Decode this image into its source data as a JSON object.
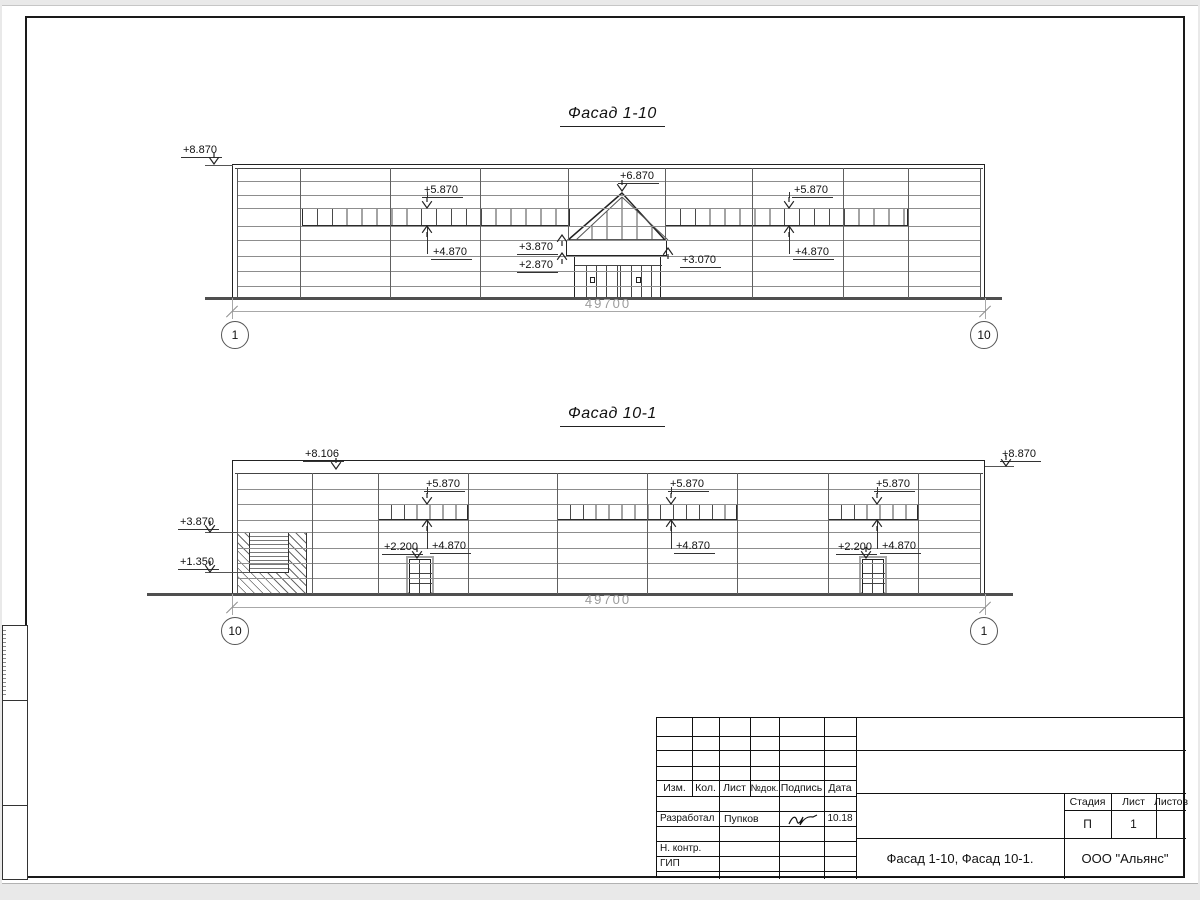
{
  "sheet": {
    "facade1": {
      "title": "Фасад 1-10",
      "dimension": "49700",
      "axis_left": "1",
      "axis_right": "10",
      "marks": {
        "top_left": "+8.870",
        "band_left_top": "+5.870",
        "band_left_bottom": "+4.870",
        "apex": "+6.870",
        "canopy_left_upper": "+3.870",
        "canopy_left_lower": "+2.870",
        "canopy_right": "+3.070",
        "band_right_top": "+5.870",
        "band_right_bottom": "+4.870"
      }
    },
    "facade2": {
      "title": "Фасад 10-1",
      "dimension": "49700",
      "axis_left": "10",
      "axis_right": "1",
      "marks": {
        "parapet": "+8.106",
        "top_right": "+8.870",
        "wall_upper": "+3.870",
        "wall_lower": "+1.350",
        "band_left_top": "+5.870",
        "door_left": "+2.200",
        "band_left_bottom": "+4.870",
        "band_mid_top": "+5.870",
        "band_mid_bottom": "+4.870",
        "band_right_top": "+5.870",
        "door_right": "+2.200",
        "band_right_bottom": "+4.870"
      }
    },
    "title_block": {
      "col_izm": "Изм.",
      "col_kol": "Кол.",
      "col_list": "Лист",
      "col_ndok": "№док.",
      "col_podpis": "Подпись",
      "col_data": "Дата",
      "row_developed": "Разработал",
      "developed_name": "Пупков",
      "developed_date": "10.18",
      "row_ncontr": "Н. контр.",
      "row_gip": "ГИП",
      "doc_title": "Фасад 1-10, Фасад 10-1.",
      "company": "ООО \"Альянс\"",
      "stage_label": "Стадия",
      "sheet_label": "Лист",
      "sheets_label": "Листов",
      "stage_value": "П",
      "sheet_value": "1",
      "sheets_value": ""
    }
  }
}
